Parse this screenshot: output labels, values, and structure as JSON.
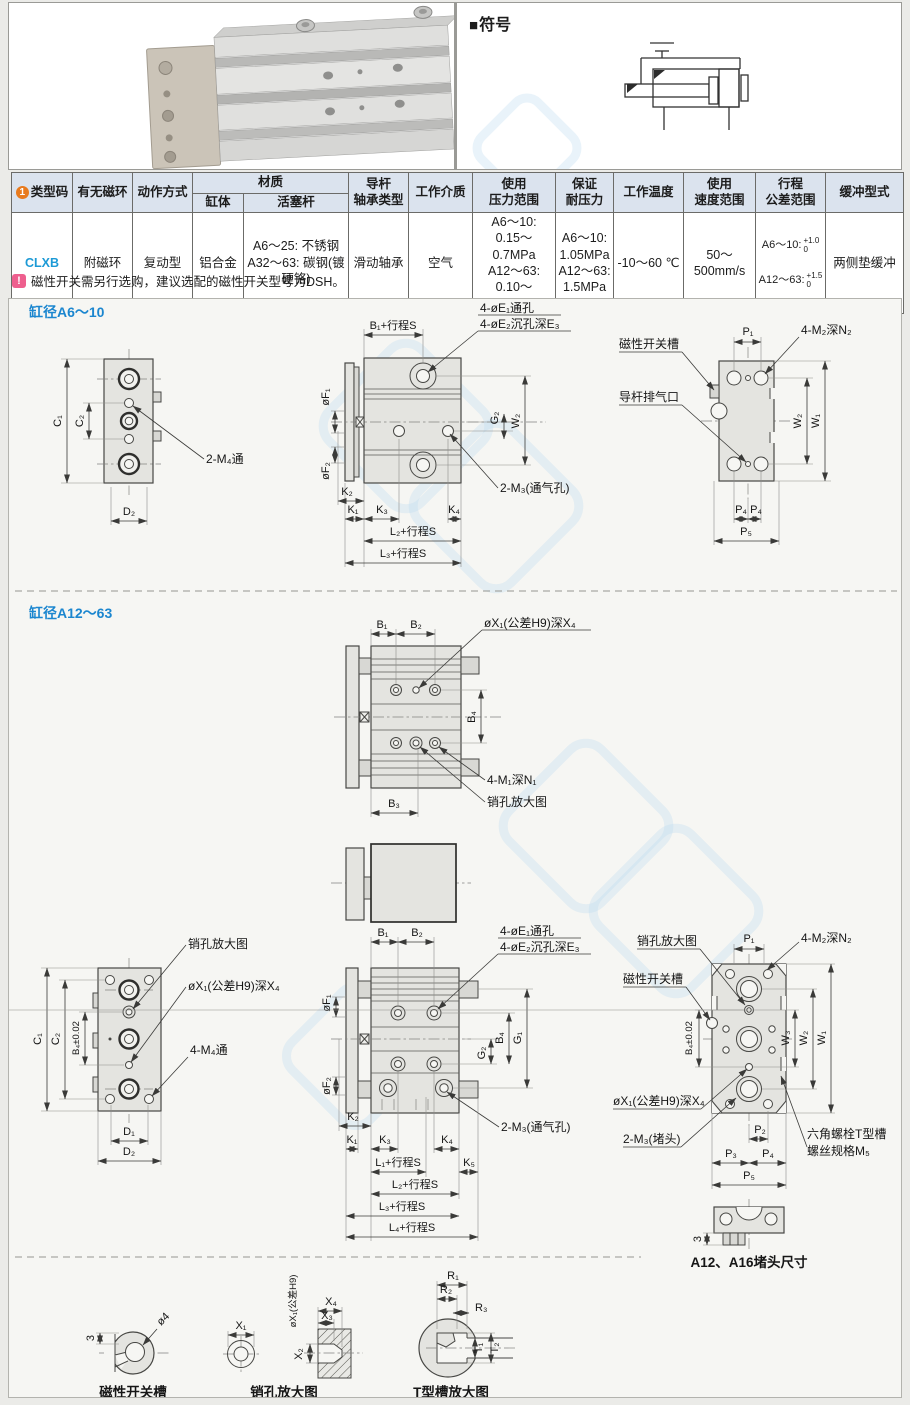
{
  "top": {
    "symbol_icon": "■",
    "symbol_title": "符号"
  },
  "table": {
    "headers": {
      "code_badge": "1",
      "code": "类型码",
      "magnet": "有无磁环",
      "action": "动作方式",
      "material": "材质",
      "body": "缸体",
      "rod": "活塞杆",
      "bearing": "导杆\n轴承类型",
      "medium": "工作介质",
      "pressure": "使用\n压力范围",
      "proof": "保证\n耐压力",
      "temp": "工作温度",
      "speed": "使用\n速度范围",
      "stroke": "行程\n公差范围",
      "cushion": "缓冲型式"
    },
    "row": {
      "code": "CLXB",
      "magnet": "附磁环",
      "action": "复动型",
      "body": "铝合金",
      "rod": "A6～25: 不锈钢\nA32～63: 碳钢(镀硬铬)",
      "bearing": "滑动轴承",
      "medium": "空气",
      "pressure": "A6～10:\n0.15～0.7MPa\nA12～63:\n0.10～1.0MPa",
      "proof": "A6～10:\n1.05MPa\nA12～63:\n1.5MPa",
      "temp": "-10～60 ℃",
      "speed": "50～500mm/s",
      "stroke": {
        "l1": "A6～10:",
        "l1_top": "+1.0",
        "l1_bot": "0",
        "l2": "A12～63:",
        "l2_top": "+1.5",
        "l2_bot": "0"
      },
      "cushion": "两侧垫缓冲"
    }
  },
  "note": {
    "icon": "!",
    "text": "磁性开关需另行选购，建议选配的磁性开关型号为DSH。"
  },
  "dr": {
    "a6": {
      "title": "缸径A6～10",
      "left": {
        "c1": "C₁",
        "c2": "C₂",
        "d2": "D₂",
        "m4": "2-M₄通"
      },
      "mid": {
        "b1s": "B₁+行程S",
        "e1": "4-øE₁通孔",
        "e2": "4-øE₂沉孔深E₃",
        "f1": "øF₁",
        "f2": "øF₂",
        "g2": "G₂",
        "w2": "W₂",
        "k2": "K₂",
        "k1": "K₁",
        "k3": "K₃",
        "k4": "K₄",
        "l2s": "L₂+行程S",
        "l3s": "L₃+行程S",
        "m3": "2-M₃(通气孔)"
      },
      "right": {
        "p1": "P₁",
        "m2": "4-M₂深N₂",
        "slot": "磁性开关槽",
        "vent": "导杆排气口",
        "w2": "W₂",
        "w1": "W₁",
        "p4a": "P₄",
        "p4b": "P₄",
        "p5": "P₅"
      }
    },
    "a12": {
      "title": "缸径A12～63",
      "top": {
        "b1": "B₁",
        "b2": "B₂",
        "x1": "øX₁(公差H9)深X₄",
        "b4": "B₄",
        "m1": "4-M₁深N₁",
        "pin": "销孔放大图",
        "b3": "B₃"
      },
      "left": {
        "pin": "销孔放大图",
        "x1": "øX₁(公差H9)深X₄",
        "m4": "4-M₄通",
        "c1": "C₁",
        "c2": "C₂",
        "b4t": "B₄±0.02",
        "d1": "D₁",
        "d2": "D₂"
      },
      "mid": {
        "b1": "B₁",
        "b2": "B₂",
        "e1": "4-øE₁通孔",
        "e2": "4-øE₂沉孔深E₃",
        "f1": "øF₁",
        "f2": "øF₂",
        "g2": "G₂",
        "b4": "B₄",
        "g1": "G₁",
        "k2": "K₂",
        "k1": "K₁",
        "k3": "K₃",
        "k4": "K₄",
        "k5": "K₅",
        "l1s": "L₁+行程S",
        "l2s": "L₂+行程S",
        "l3s": "L₃+行程S",
        "l4s": "L₄+行程S",
        "m3": "2-M₃(通气孔)"
      },
      "right": {
        "pin": "销孔放大图",
        "slot": "磁性开关槽",
        "p1": "P₁",
        "m2": "4-M₂深N₂",
        "b4t": "B₄±0.02",
        "w3": "W₃",
        "w2": "W₂",
        "w1": "W₁",
        "x1": "øX₁(公差H9)深X₄",
        "m3p": "2-M₃(堵头)",
        "ts1": "六角螺栓T型槽",
        "ts2": "螺丝规格M₅",
        "p2": "P₂",
        "p3": "P₃",
        "p4": "P₄",
        "p5": "P₅"
      },
      "plug": {
        "cap": "A12、A16堵头尺寸",
        "d3": "3"
      }
    },
    "det": {
      "sw": {
        "cap": "磁性开关槽",
        "d3": "3",
        "d4": "ø4"
      },
      "pin": {
        "cap": "销孔放大图",
        "x1": "X₁",
        "x2": "X₂",
        "xh9": "øX₁(公差H9)",
        "x3": "X₃",
        "x4": "X₄"
      },
      "ts": {
        "cap": "T型槽放大图",
        "r1": "R₁",
        "r2": "R₂",
        "r3": "R₃",
        "t1": "T₁",
        "t2": "T₂"
      }
    }
  }
}
